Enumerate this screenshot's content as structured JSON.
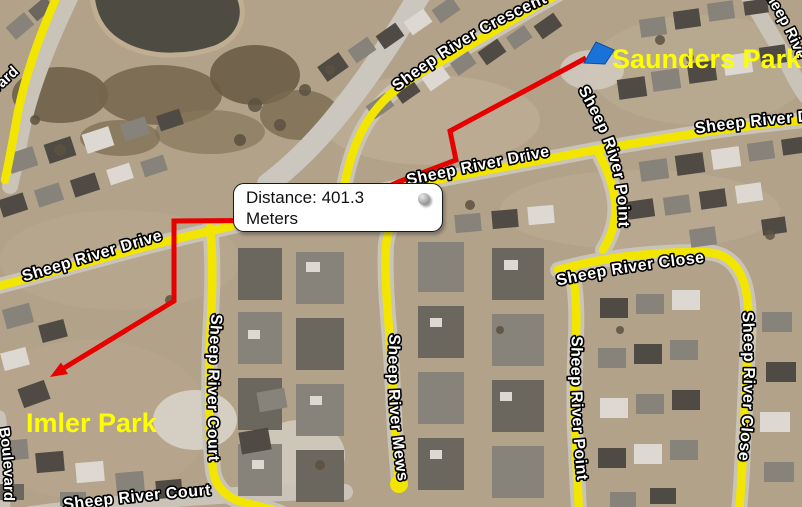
{
  "tooltip": {
    "line1": "Distance: 401.3",
    "line2": "Meters",
    "icon": "globe-icon"
  },
  "parks": [
    {
      "name": "Saunders Park",
      "marker": "blue-flag"
    },
    {
      "name": "Imler Park",
      "marker": "red-arrowhead"
    }
  ],
  "road_labels": [
    {
      "text": "vard"
    },
    {
      "text": "Sheep River Crescent"
    },
    {
      "text": "Sheep River Drive"
    },
    {
      "text": "Sheep River Drive"
    },
    {
      "text": "Sheep River Point"
    },
    {
      "text": "Sheep River Close"
    },
    {
      "text": "Sheep River Drive"
    },
    {
      "text": "Sheep River Court"
    },
    {
      "text": "Sheep River Mews"
    },
    {
      "text": "Sheep River Point"
    },
    {
      "text": "Sheep River Close"
    },
    {
      "text": "Sheep River Court"
    },
    {
      "text": "Boulevard"
    },
    {
      "text": "Sheep River"
    }
  ],
  "colors": {
    "road_highlight": "#f2e600",
    "route": "#e60000",
    "park_label": "#fdff00",
    "destination_flag": "#1a72d8"
  }
}
